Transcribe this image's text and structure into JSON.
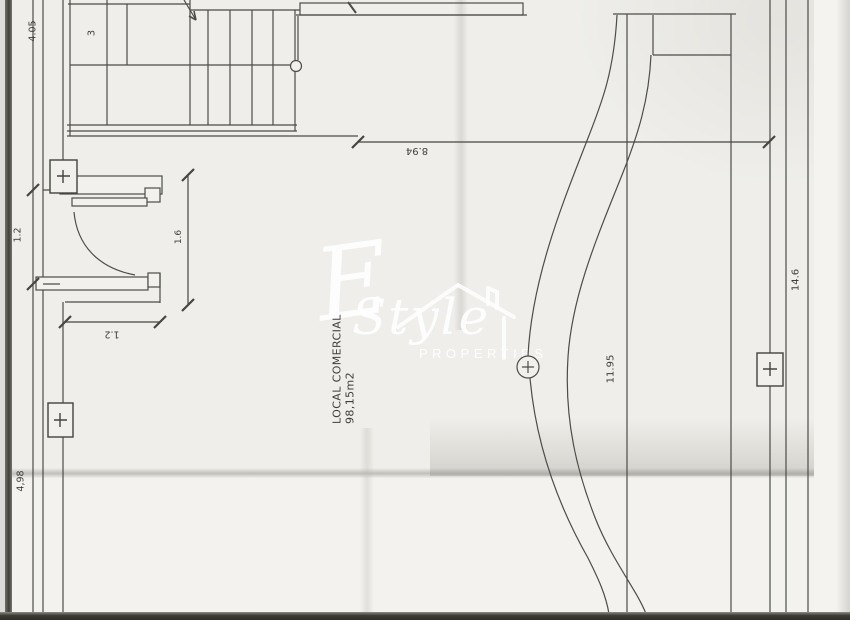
{
  "plan": {
    "room": {
      "name": "LOCAL COMERCIAL",
      "area": "98,15m2"
    },
    "dimensions": {
      "left_top": "4.05",
      "stairs_room": "3",
      "width_top": "8.94",
      "door_clear": "1.6",
      "door_wall": "1.2",
      "left_mid": "1.2",
      "left_bottom": "4,98",
      "curve_length": "11.95",
      "right_height": "14.6"
    }
  },
  "watermark": {
    "initial": "E",
    "brand": "Style",
    "subtitle": "PROPERTIES"
  }
}
